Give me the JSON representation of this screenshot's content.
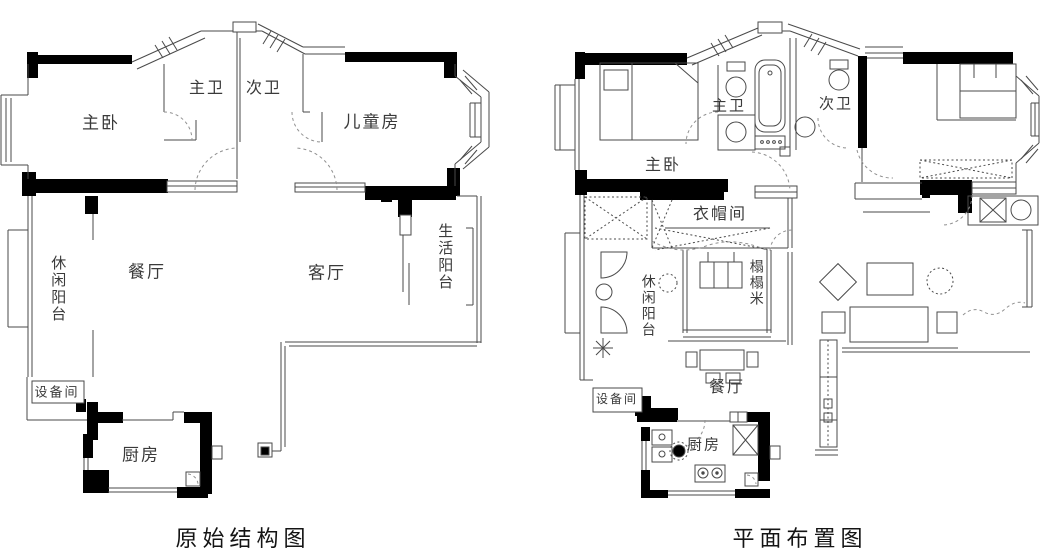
{
  "left_plan": {
    "title": "原始结构图",
    "rooms": {
      "master_bedroom": "主卧",
      "master_bath": "主卫",
      "second_bath": "次卫",
      "kids_room": "儿童房",
      "leisure_balcony": "休闲阳台",
      "dining_room": "餐厅",
      "living_room": "客厅",
      "utility_balcony": "生活阳台",
      "equipment_room": "设备间",
      "kitchen": "厨房"
    }
  },
  "right_plan": {
    "title": "平面布置图",
    "rooms": {
      "master_bedroom": "主卧",
      "master_bath": "主卫",
      "second_bath": "次卫",
      "cloakroom": "衣帽间",
      "leisure_balcony": "休闲阳台",
      "tatami": "榻榻米",
      "dining_room": "餐厅",
      "equipment_room": "设备间",
      "kitchen": "厨房"
    }
  },
  "colors": {
    "wall": "#000000",
    "line": "#4a4a4a",
    "door_dash": "#909090",
    "background": "#ffffff",
    "text": "#3a3a3a"
  }
}
